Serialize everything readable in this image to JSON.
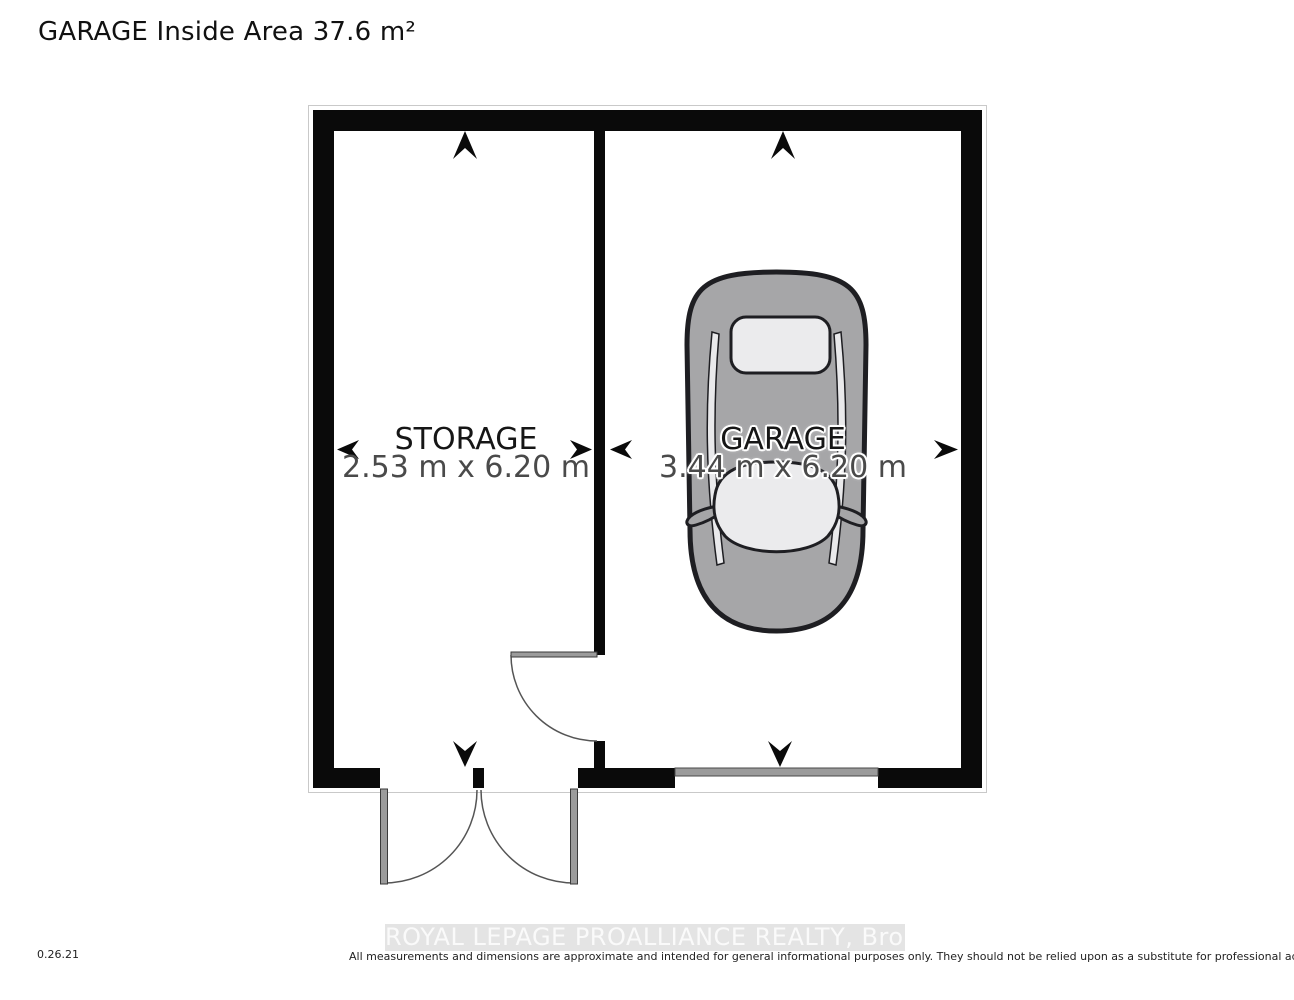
{
  "page": {
    "title": "GARAGE Inside Area 37.6 m²",
    "version_code": "0.26.21",
    "watermark": "ROYAL LEPAGE PROALLIANCE REALTY, Brokerage",
    "disclaimer": "All measurements and dimensions are approximate and intended for general informational purposes only. They should not be relied upon as a substitute for professional advice or accurate surveying."
  },
  "floor_plan": {
    "area_label": "GARAGE Inside Area 37.6 m²",
    "rooms": [
      {
        "name": "STORAGE",
        "dimensions": "2.53 m x 6.20 m"
      },
      {
        "name": "GARAGE",
        "dimensions": "3.44 m x 6.20 m"
      }
    ],
    "icons": [
      "car-top-view-icon",
      "double-entry-door-swing",
      "interior-door-swing",
      "garage-overhead-door",
      "dimension-arrows"
    ],
    "colors": {
      "wall": "#0a0a0a",
      "car_body": "#a6a6a8",
      "car_glass": "#ebebed",
      "door_leaf": "#9b9b9b",
      "dim_text": "#4a4a4a",
      "watermark_bg": "#e4e4e4",
      "watermark_text": "#fafafa"
    }
  }
}
